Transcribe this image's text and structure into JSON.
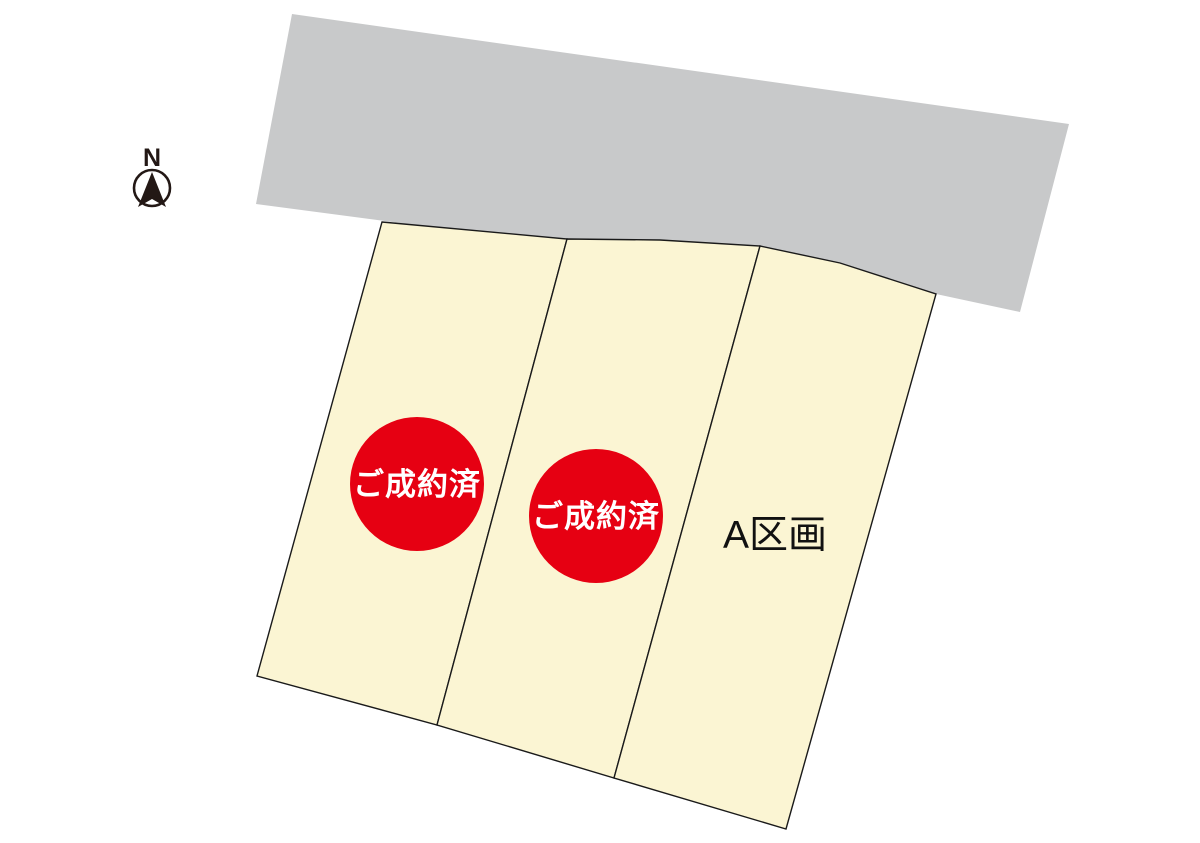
{
  "compass": {
    "label": "N"
  },
  "lots": [
    {
      "name": "lot-1",
      "sold": true,
      "status_badge": "ご成約済"
    },
    {
      "name": "lot-2",
      "sold": true,
      "status_badge": "ご成約済"
    },
    {
      "name": "lot-a",
      "sold": false,
      "label": "A区画"
    }
  ],
  "colors": {
    "road_fill": "#C8C9CA",
    "lot_fill": "#FBF5D3",
    "sold_badge_fill": "#E60012",
    "badge_text": "#FFFFFF",
    "label_text": "#111111",
    "outline": "#1A1A1A",
    "compass": "#231815"
  }
}
